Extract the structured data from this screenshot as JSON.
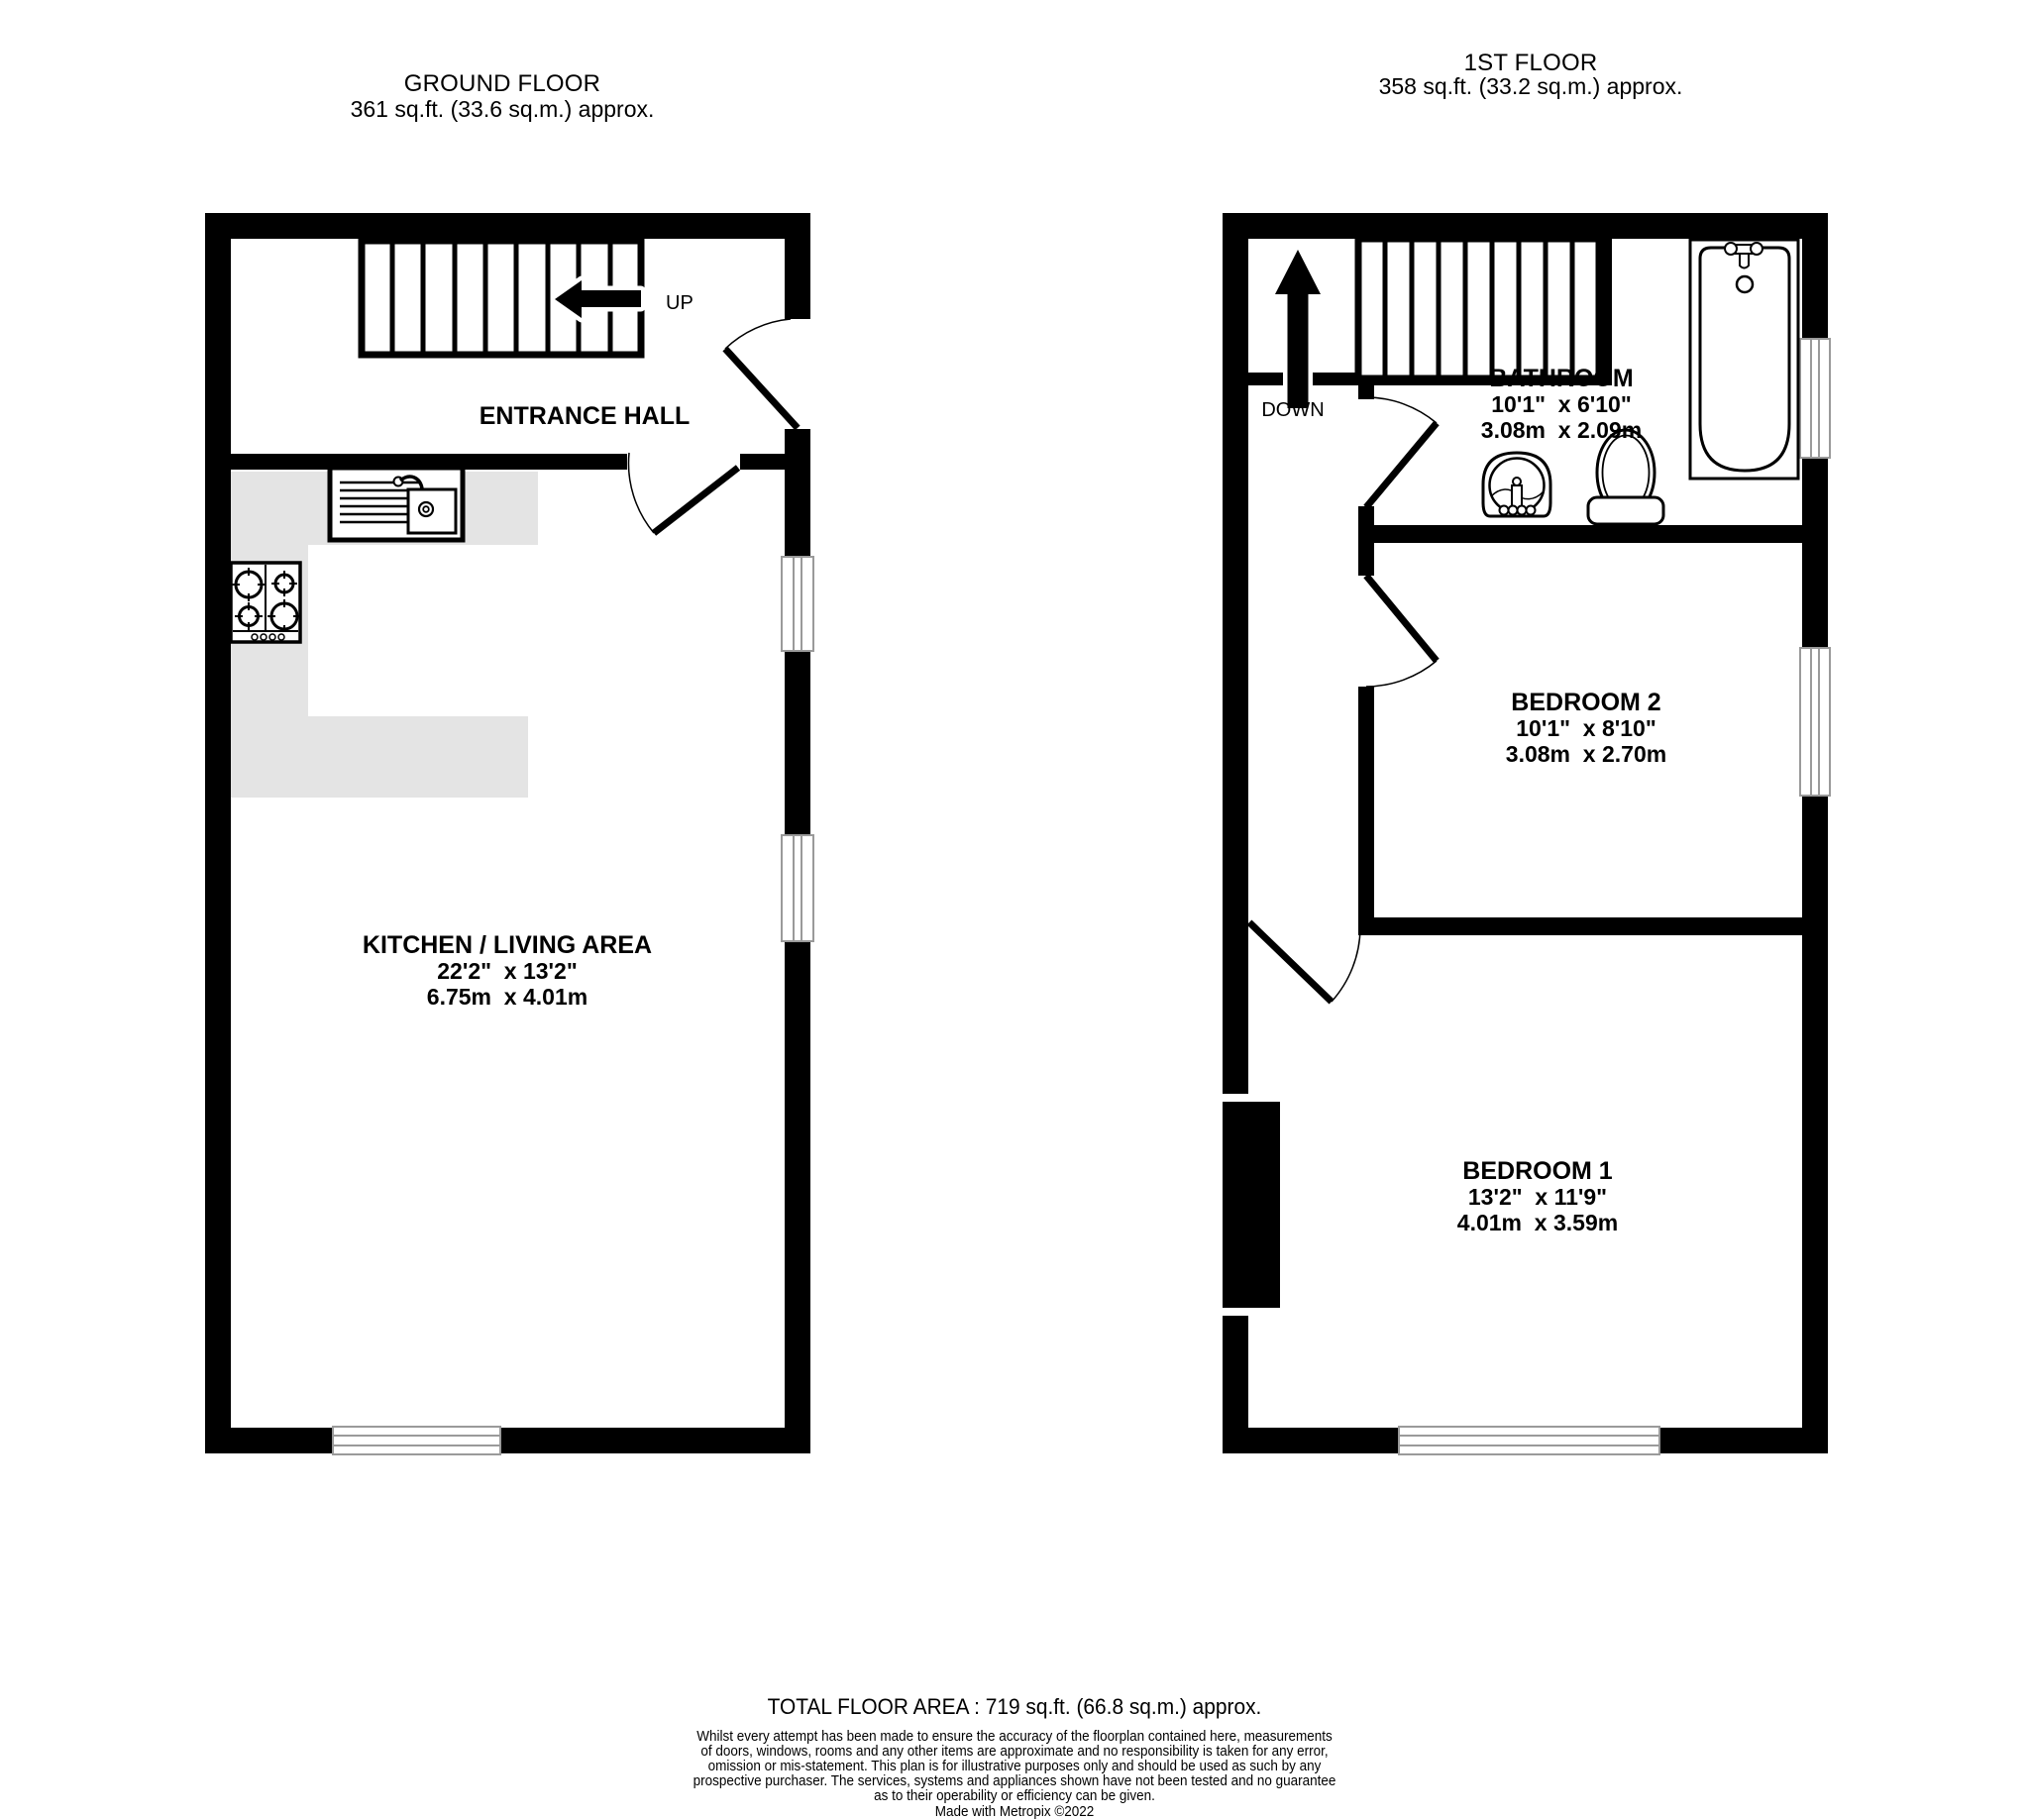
{
  "colors": {
    "wall": "#000000",
    "counter": "#e4e4e4",
    "window_line": "#9a9a9a",
    "background": "#ffffff"
  },
  "ground_floor": {
    "header": {
      "title": "GROUND FLOOR",
      "area": "361 sq.ft. (33.6 sq.m.) approx."
    },
    "stairs_label": "UP",
    "rooms": {
      "entrance_hall": {
        "name": "ENTRANCE HALL"
      },
      "kitchen_living": {
        "name": "KITCHEN / LIVING AREA",
        "dims_imperial": "22'2\"  x 13'2\"",
        "dims_metric": "6.75m  x 4.01m"
      }
    },
    "fixtures": [
      "sink-icon",
      "hob-icon",
      "stairs-up-arrow-icon"
    ]
  },
  "first_floor": {
    "header": {
      "title": "1ST FLOOR",
      "area": "358 sq.ft. (33.2 sq.m.) approx."
    },
    "stairs_label": "DOWN",
    "rooms": {
      "bathroom": {
        "name": "BATHROOM",
        "dims_imperial": "10'1\"  x 6'10\"",
        "dims_metric": "3.08m  x 2.09m"
      },
      "bedroom2": {
        "name": "BEDROOM 2",
        "dims_imperial": "10'1\"  x 8'10\"",
        "dims_metric": "3.08m  x 2.70m"
      },
      "bedroom1": {
        "name": "BEDROOM 1",
        "dims_imperial": "13'2\"  x 11'9\"",
        "dims_metric": "4.01m  x 3.59m"
      }
    },
    "fixtures": [
      "bath-icon",
      "toilet-icon",
      "basin-icon",
      "stairs-down-arrow-icon",
      "chimney-breast"
    ]
  },
  "footer": {
    "total": "TOTAL FLOOR AREA : 719 sq.ft. (66.8 sq.m.) approx.",
    "disclaimer_lines": [
      "Whilst every attempt has been made to ensure the accuracy of the floorplan contained here, measurements",
      "of doors, windows, rooms and any other items are approximate and no responsibility is taken for any error,",
      "omission or mis-statement. This plan is for illustrative purposes only and should be used as such by any",
      "prospective purchaser. The services, systems and appliances shown have not been tested and no guarantee",
      "as to their operability or efficiency can be given."
    ],
    "credit": "Made with Metropix ©2022"
  }
}
